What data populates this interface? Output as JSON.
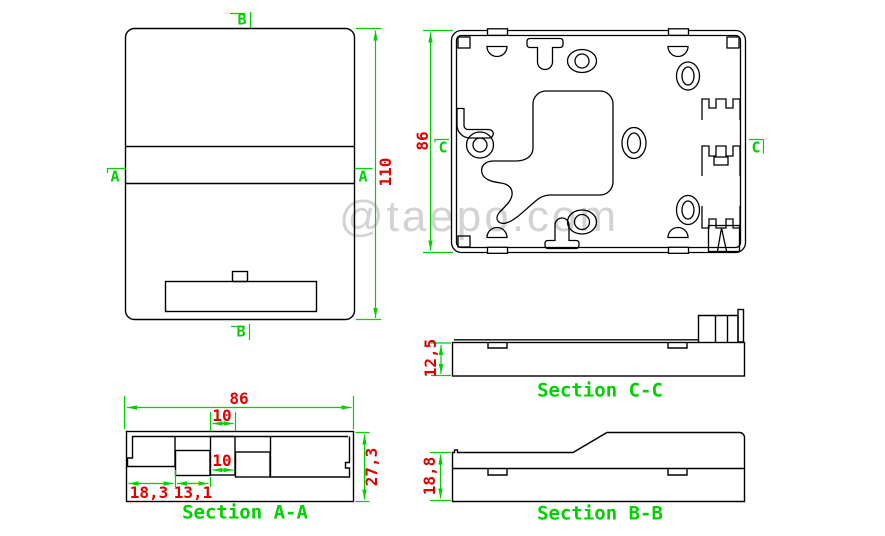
{
  "watermark": "@taepo.com",
  "palette": {
    "line": "#000000",
    "dimension_lines": "#00d000",
    "dimension_text": "#e00000",
    "watermark_text": "#d3d3d3",
    "background": "#ffffff"
  },
  "front_view": {
    "marker_top": "B",
    "marker_bottom": "B",
    "marker_left": "A",
    "marker_right": "A",
    "dim_height": "110"
  },
  "internal_view": {
    "marker_left": "C",
    "marker_right": "C",
    "dim_height": "86"
  },
  "section_aa": {
    "label": "Section A-A",
    "dim_width": "86",
    "dim_slot_top": "10",
    "dim_slot_bottom": "10",
    "dim_left_pocket": "18,3",
    "dim_mid_pocket": "13,1",
    "dim_height": "27,3"
  },
  "section_cc": {
    "label": "Section C-C",
    "dim_height": "12,5"
  },
  "section_bb": {
    "label": "Section B-B",
    "dim_height": "18,8"
  }
}
